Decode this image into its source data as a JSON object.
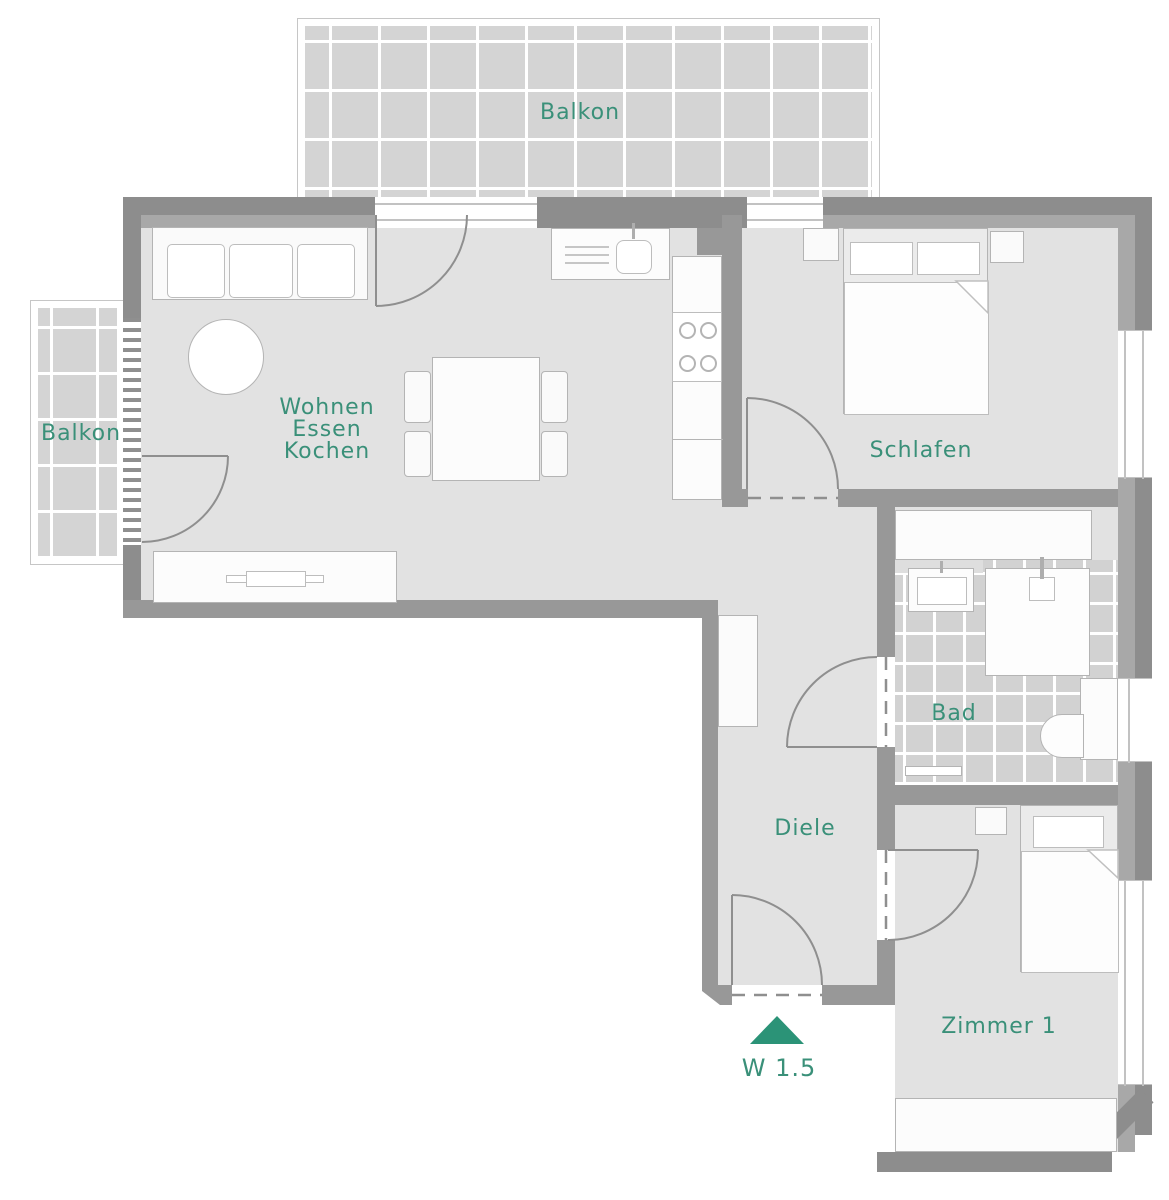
{
  "plan_title": "W 1.5",
  "labels": {
    "balcony_top": "Balkon",
    "balcony_left": "Balkon",
    "living_1": "Wohnen",
    "living_2": "Essen",
    "living_3": "Kochen",
    "bedroom": "Schlafen",
    "bathroom": "Bad",
    "hallway": "Diele",
    "room1": "Zimmer 1",
    "unit": "W 1.5"
  },
  "colors": {
    "accent_teal": "#2b9377",
    "label_teal": "#3a9079",
    "wall_dark": "#8d8d8d",
    "wall_mid": "#989898",
    "wall_light": "#a8a8a8",
    "floor": "#e2e2e2",
    "tile": "#d4d4d4",
    "furniture": "#fafafa"
  },
  "rooms": [
    "Balkon (oben)",
    "Balkon (links)",
    "Wohnen Essen Kochen",
    "Schlafen",
    "Bad",
    "Diele",
    "Zimmer 1"
  ],
  "entrance_marker": {
    "symbol": "triangle-up",
    "label": "W 1.5"
  }
}
